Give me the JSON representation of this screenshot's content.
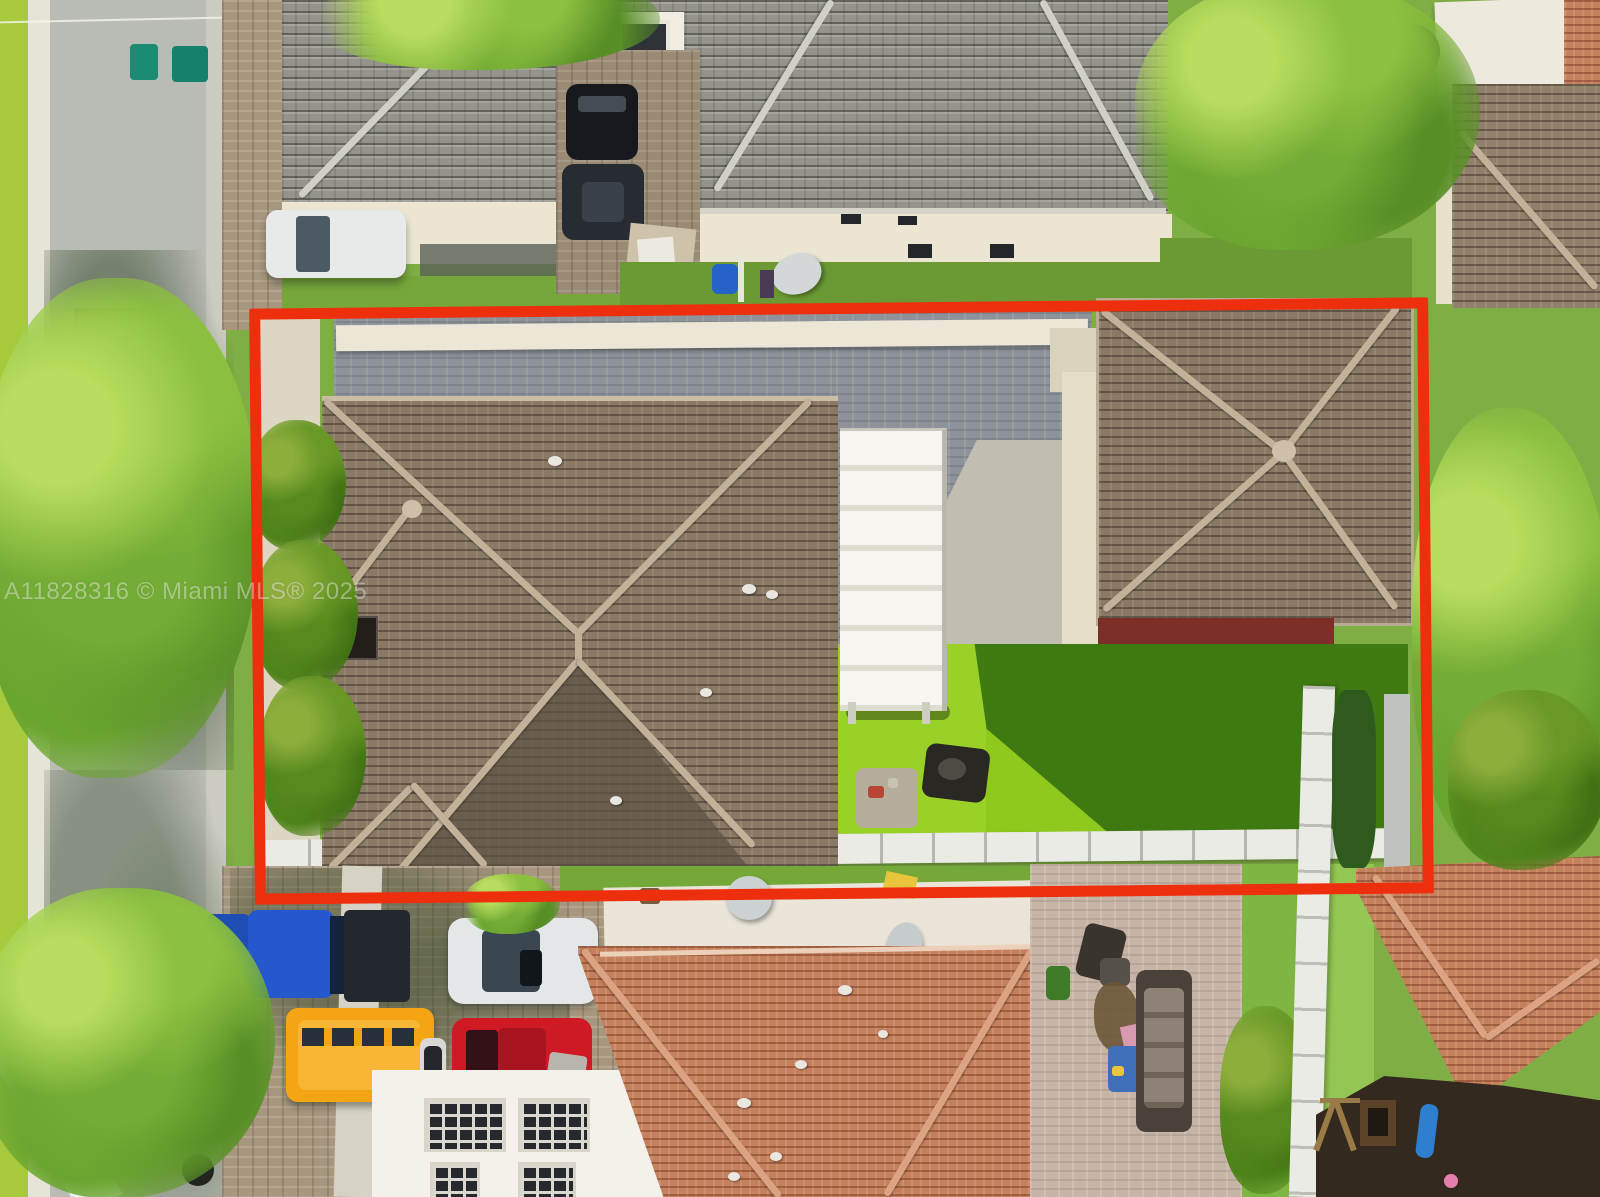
{
  "image": {
    "type": "aerial-drone-real-estate-photo",
    "width_px": 1600,
    "height_px": 1197
  },
  "watermark": {
    "text": "A11828316 © Miami MLS® 2025",
    "color": "#ffffff",
    "opacity": 0.62
  },
  "property_outline": {
    "shape": "rectangle",
    "color": "#ee2f0d",
    "stroke_px": 11
  },
  "palette": {
    "street_asphalt": "#b9bcb4",
    "grass_verge": "#a6c93e",
    "lawn_grass": "#7cb23b",
    "artificial_turf": "#8fc91e",
    "turf_shadow": "#377310",
    "grey_tile_roof": "#94948c",
    "brown_tile_roof": "#8a7a65",
    "orange_tile_roof": "#c5805c",
    "ridge_cap": "#c3b29a",
    "courtyard_pavers": "#8e939b",
    "driveway_pavers": "#a8977f",
    "patio_pavers": "#c6b4a6",
    "stucco_wall": "#ece5d2",
    "maroon_wall": "#7c2f26",
    "white_fence": "#eaebe4",
    "pergola_white": "#f4f3ee",
    "tree_canopy": "#7db539"
  },
  "scene": {
    "highlighted_property": {
      "main_house": "brown tile hip roof with chimney and roof vents",
      "rear_structure": "detached garage with brown hip roof, cream walls and maroon rear wall",
      "pergola": "white slatted flat-roof pergola between house and garage",
      "courtyard": "grey paver courtyard, partly sunlit",
      "backyard": "bright artificial turf with BBQ grill and side table, right half in shadow",
      "boundary_features": [
        "white perimeter wall at front",
        "white rail fence at rear",
        "palm trees along street side"
      ]
    },
    "neighborhood": {
      "top_left_house": "grey tile roof two-story with white dormer window",
      "top_center_house": "large grey tile hip roof, cream stucco walls, rear yard with barrel and satellite dish",
      "bottom_center_house": "terracotta tile roof with white flat-roof section and satellite dishes",
      "bottom_right": "paver patio with outdoor sectional, chairs, and a mulch playground with blue slide",
      "right": "neighboring tile roofs among large trees",
      "street": "asphalt street along left edge with grass verge, curb, brick mailbox and utility line"
    },
    "vehicles": [
      {
        "id": "white-van",
        "color": "#e7eae8",
        "location": "top-left driveway"
      },
      {
        "id": "black-suv",
        "color": "#17191e",
        "location": "upper paver driveway"
      },
      {
        "id": "dark-grey-car",
        "color": "#272c33",
        "location": "upper paver driveway"
      },
      {
        "id": "blue-pickup-truck",
        "color": "#2458cc",
        "location": "lower driveway"
      },
      {
        "id": "white-suv",
        "color": "#e3e7e7",
        "location": "lower driveway"
      },
      {
        "id": "orange-van",
        "color": "#f5a514",
        "location": "lower driveway"
      },
      {
        "id": "red-suv",
        "color": "#cf1a26",
        "location": "lower driveway"
      }
    ],
    "objects": [
      {
        "id": "teal-trash-bins",
        "count": 3
      },
      {
        "id": "satellite-dishes",
        "count": 3
      },
      {
        "id": "blue-barrel"
      },
      {
        "id": "cardboard-boxes",
        "count": 2
      },
      {
        "id": "bbq-grill"
      },
      {
        "id": "black-patio-umbrella"
      },
      {
        "id": "white-boat-trailer"
      },
      {
        "id": "playground-slide",
        "color": "#2e7fd0"
      },
      {
        "id": "pink-ball",
        "color": "#e57fb0"
      }
    ]
  }
}
